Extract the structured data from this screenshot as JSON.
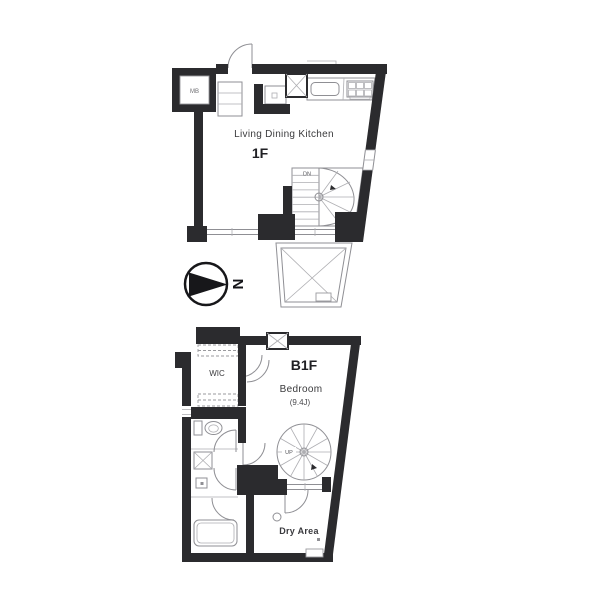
{
  "colors": {
    "wall": "#2b2b2e",
    "thin_line": "#8f8f94",
    "background": "#ffffff"
  },
  "floor_1f": {
    "label": "1F",
    "room": "Living Dining Kitchen",
    "meter_box": "MB",
    "stair": "DN"
  },
  "compass": {
    "north": "N"
  },
  "floor_b1f": {
    "label": "B1F",
    "room": "Bedroom",
    "area": "(9.4J)",
    "closet": "WIC",
    "stair": "UP",
    "dry_area": "Dry Area"
  }
}
